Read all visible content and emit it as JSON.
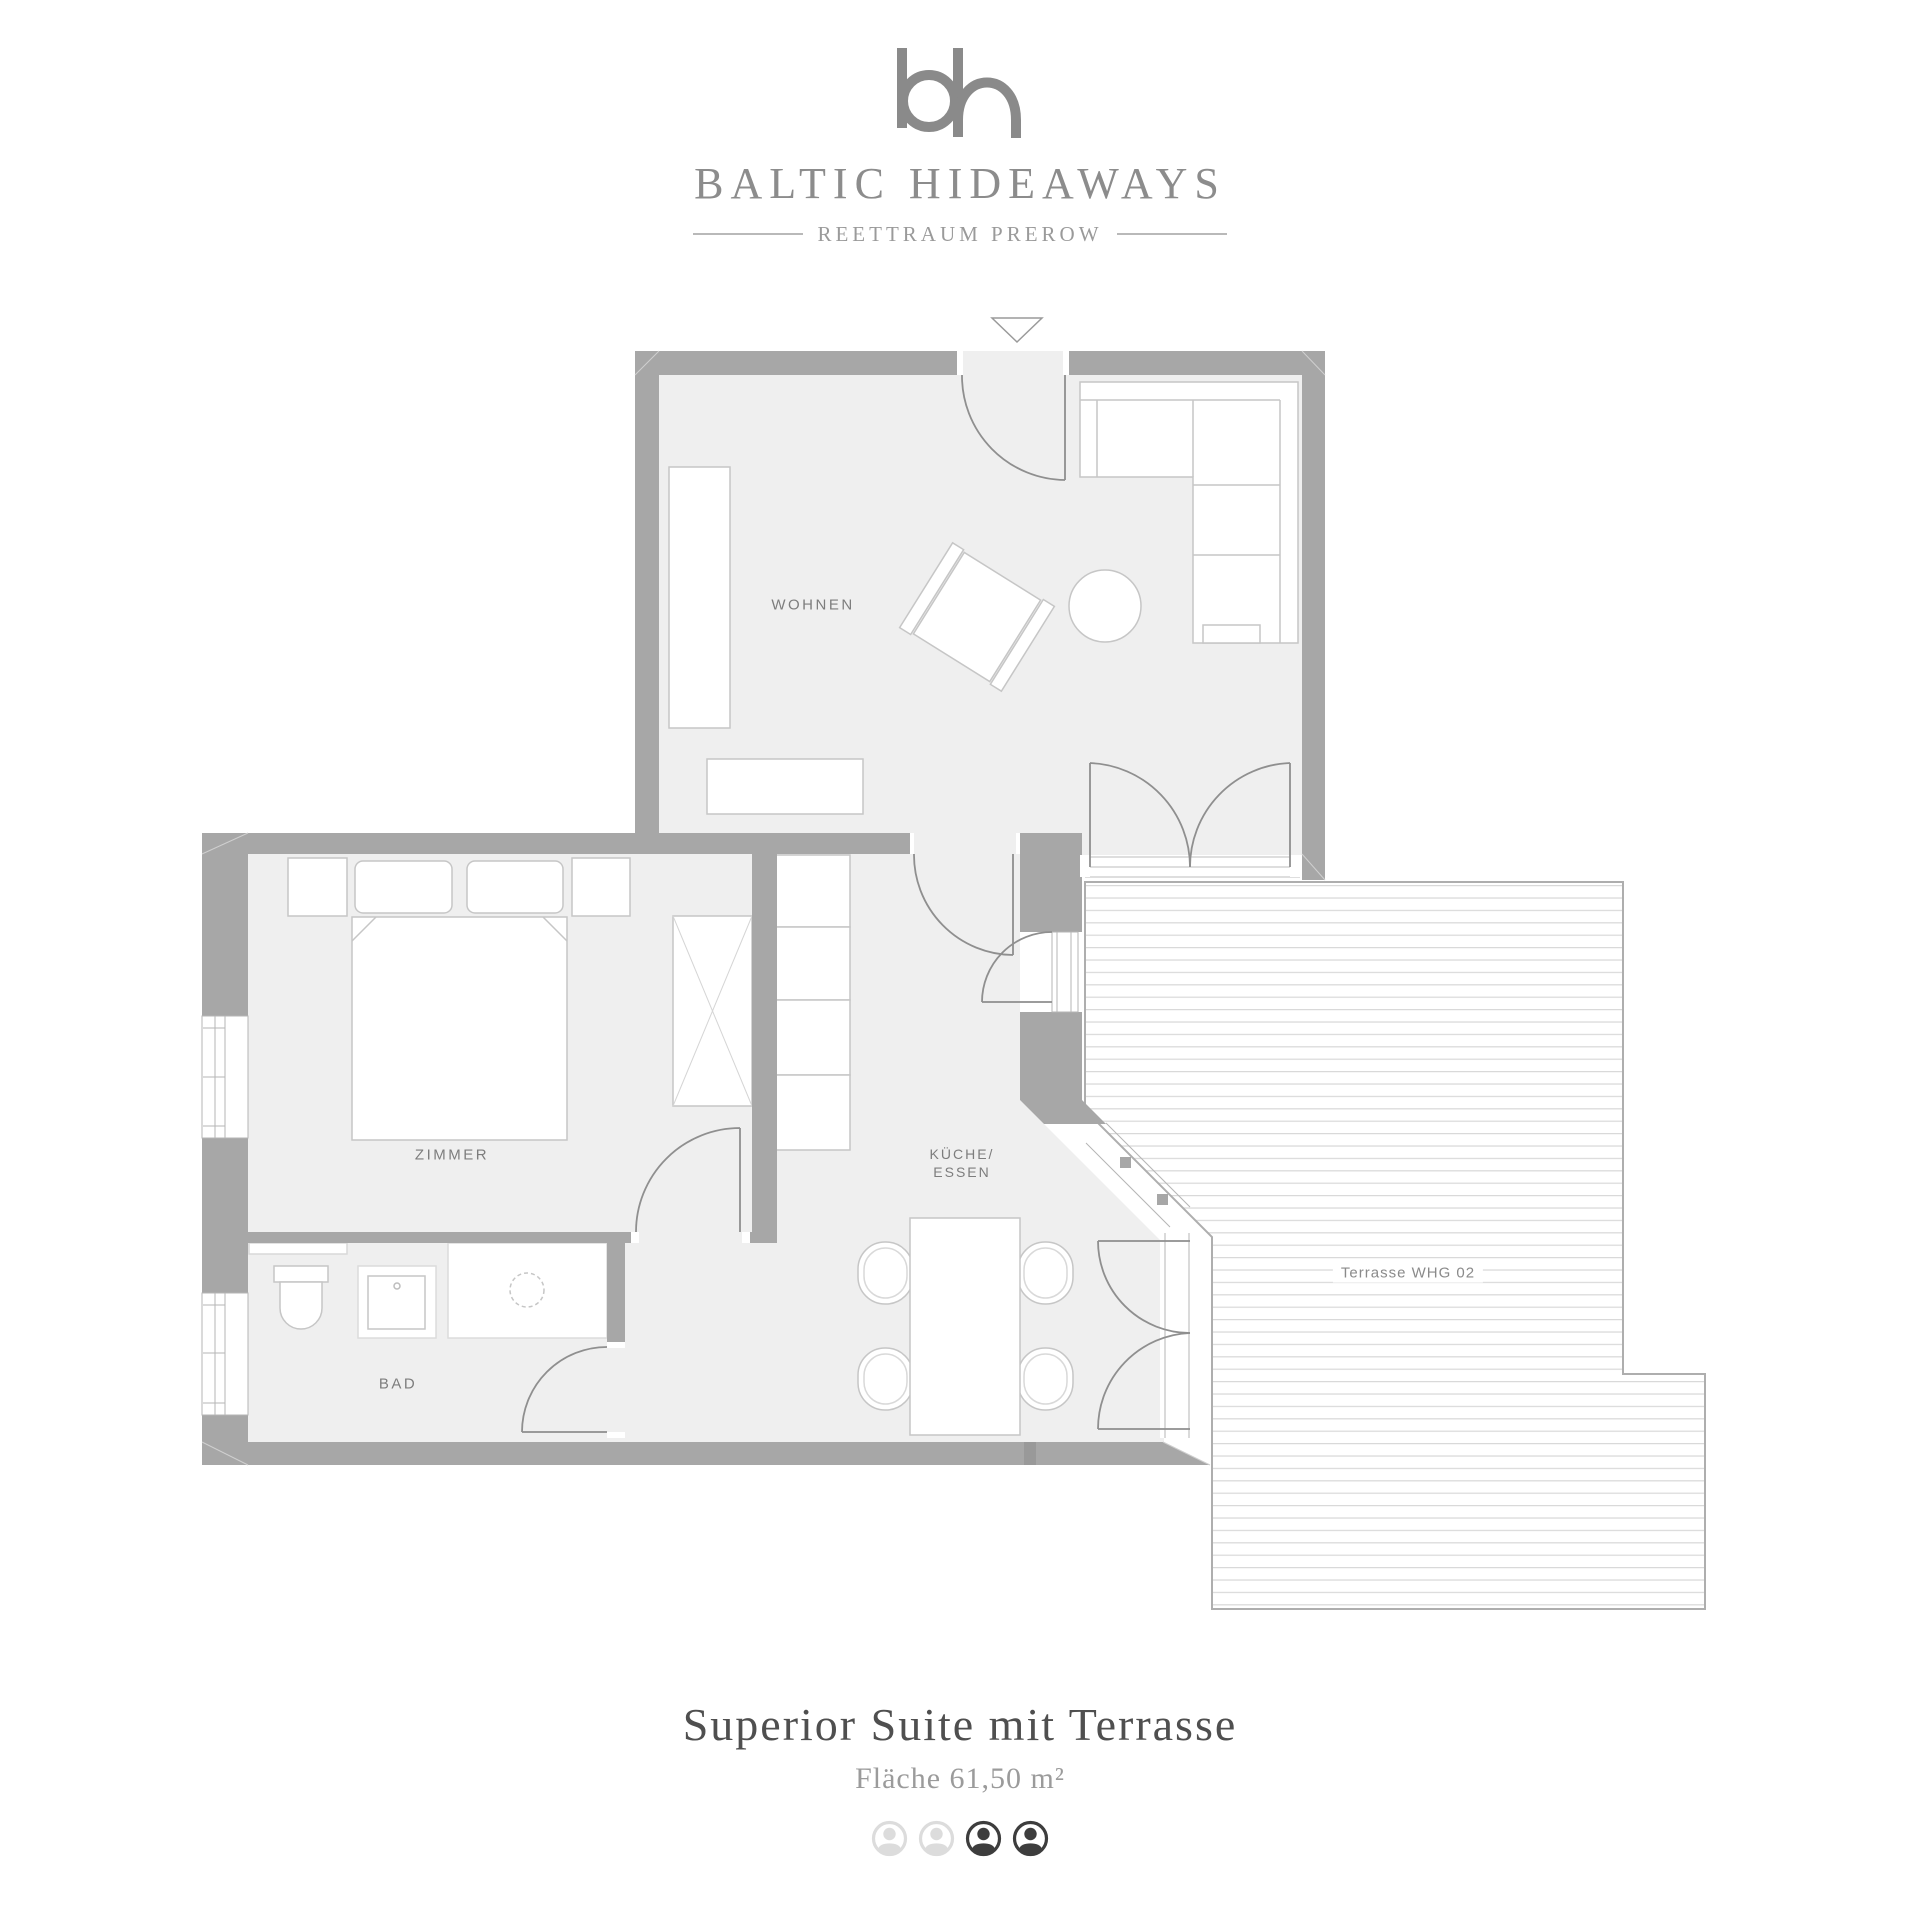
{
  "brand": {
    "monogram": "bh",
    "name": "BALTIC HIDEAWAYS",
    "tagline": "REETTRAUM PREROW"
  },
  "floorplan": {
    "labels": {
      "wohnen": "WOHNEN",
      "zimmer": "ZIMMER",
      "kueche_line1": "KÜCHE/",
      "kueche_line2": "ESSEN",
      "bad": "BAD",
      "terrasse": "Terrasse WHG 02"
    }
  },
  "footer": {
    "title": "Superior Suite mit Terrasse",
    "area": "Fläche 61,50 m²",
    "occupancy_states": [
      "inactive",
      "inactive",
      "active",
      "active"
    ]
  },
  "colors": {
    "wall": "#a7a7a7",
    "floor": "#efefef",
    "deck_line": "#d9d9d9",
    "brand_gray": "#8c8c8c",
    "title_dark": "#4f4f4f",
    "icon_active": "#3d3d3d",
    "icon_inactive": "#dcdcdc"
  }
}
